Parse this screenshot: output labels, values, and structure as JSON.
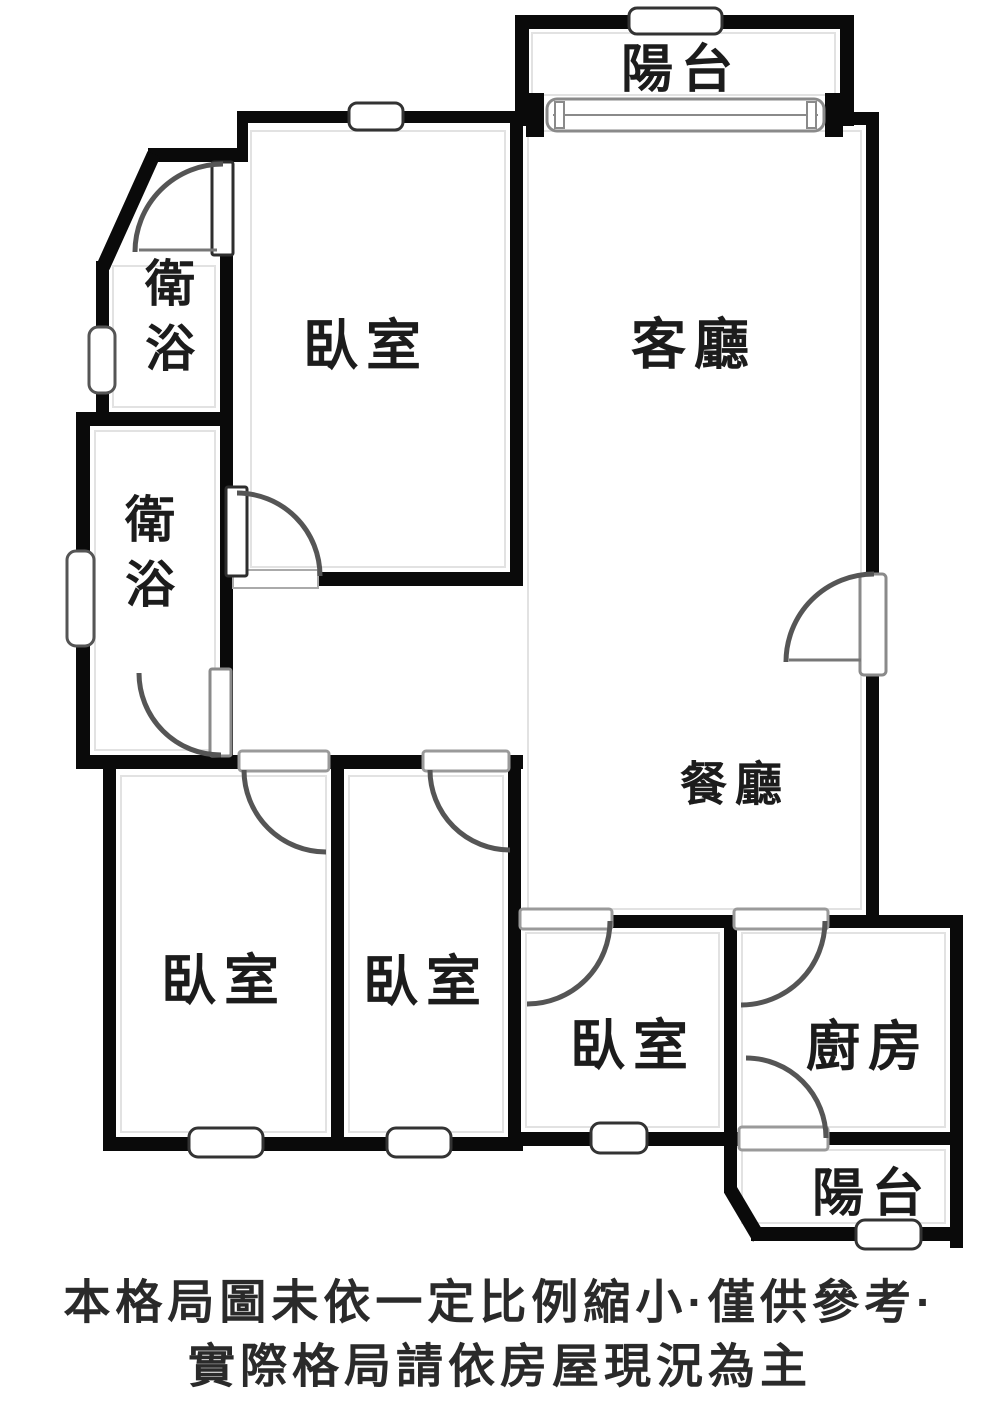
{
  "floorplan": {
    "rooms": [
      {
        "id": "balcony-top",
        "label": "陽台"
      },
      {
        "id": "bedroom-master",
        "label": "臥室"
      },
      {
        "id": "living-room",
        "label": "客廳"
      },
      {
        "id": "bathroom-upper",
        "label": "衛浴"
      },
      {
        "id": "bathroom-lower",
        "label": "衛浴"
      },
      {
        "id": "dining-room",
        "label": "餐廳"
      },
      {
        "id": "bedroom-left",
        "label": "臥室"
      },
      {
        "id": "bedroom-middle",
        "label": "臥室"
      },
      {
        "id": "bedroom-small",
        "label": "臥室"
      },
      {
        "id": "kitchen",
        "label": "廚房"
      },
      {
        "id": "balcony-bottom",
        "label": "陽台"
      }
    ],
    "colors": {
      "wall": "#0a0a0a",
      "door_arc": "#555555",
      "door_leaf_border": "#8a8a8a",
      "window_border": "#333333",
      "label_text": "#1c1c1c",
      "background": "#ffffff",
      "guide_line": "#e2e2e2"
    }
  },
  "disclaimer": {
    "line1": "本格局圖未依一定比例縮小·僅供參考·",
    "line2": "實際格局請依房屋現況為主"
  }
}
